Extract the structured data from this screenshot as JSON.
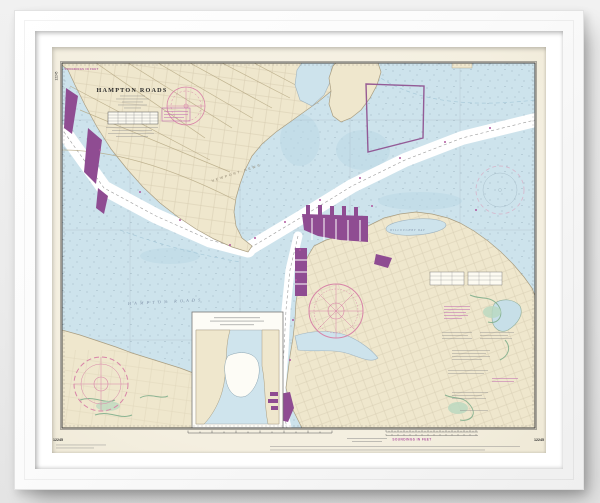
{
  "artwork": {
    "kind": "framed nautical chart print",
    "frame_color": "#fbfbfb",
    "mat_color": "#ffffff",
    "background_color": "#ececec"
  },
  "chart": {
    "number": "12245",
    "soundings_note": "SOUNDINGS IN FEET",
    "title_block": {
      "agency_line": "UNITED STATES — EAST COAST",
      "title": "HAMPTON ROADS"
    },
    "place_labels": {
      "water_main": "HAMPTON ROADS",
      "city_newport_news": "NEWPORT NEWS",
      "city_hampton": "HAMPTON",
      "bay_willoughby": "WILLOUGHBY BAY"
    },
    "margins": {
      "left_number": "12245",
      "bottom_left_number": "12245",
      "bottom_right_number": "12245",
      "bottom_soundings": "SOUNDINGS IN FEET"
    },
    "colors": {
      "paper": "#f5f1e3",
      "water": "#cde3ec",
      "land": "#efe7cd",
      "channel": "#ffffff",
      "facility_magenta": "#8f4c92",
      "note_magenta": "#c06ab0",
      "marsh_green": "#b8d8bf",
      "neatline": "#3d3d3d"
    }
  }
}
